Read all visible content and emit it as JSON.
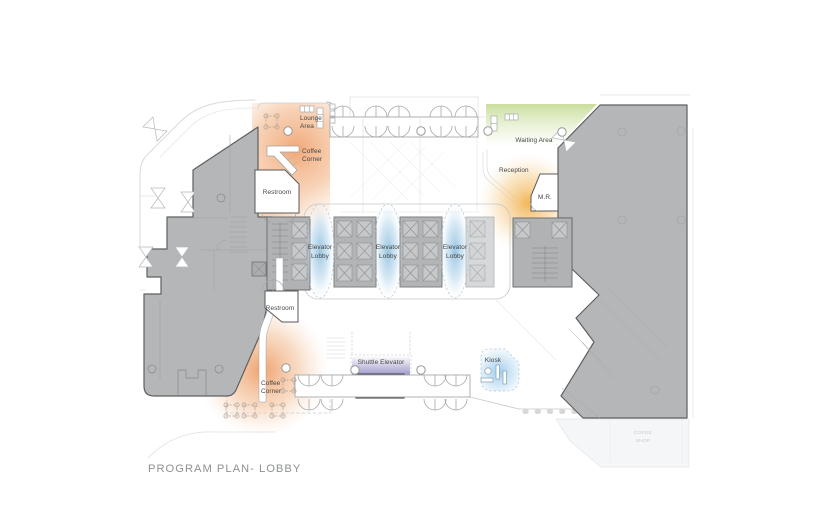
{
  "title": "PROGRAM PLAN- LOBBY",
  "labels": {
    "lounge_area": {
      "lines": [
        "Lounge",
        "Area"
      ]
    },
    "coffee_corner_upper": {
      "lines": [
        "Coffee",
        "Corner"
      ]
    },
    "restroom_upper": "Restroom",
    "restroom_lower": "Restroom",
    "coffee_corner_lower": {
      "lines": [
        "Coffee",
        "Corner"
      ]
    },
    "elevator_lobby_1": {
      "lines": [
        "Elevator",
        "Lobby"
      ]
    },
    "elevator_lobby_2": {
      "lines": [
        "Elevator",
        "Lobby"
      ]
    },
    "elevator_lobby_3": {
      "lines": [
        "Elevator",
        "Lobby"
      ]
    },
    "waiting_area": "Waiting Area",
    "reception": "Reception",
    "meeting_room": "M.R.",
    "shuttle_elevator": "Shuttle Elevator",
    "kiosk": "Kiosk",
    "coffee_shop": {
      "lines": [
        "COFEE",
        "SHOP"
      ]
    }
  },
  "colors": {
    "lounge_coffee": "#f0a06b",
    "elevator_lobby": "#8fbede",
    "waiting_area": "#c4da93",
    "reception": "#f2b24e",
    "shuttle_elevator": "#8d86c2",
    "kiosk": "#8fc4ea",
    "building_mass": "#b4b6b8"
  }
}
